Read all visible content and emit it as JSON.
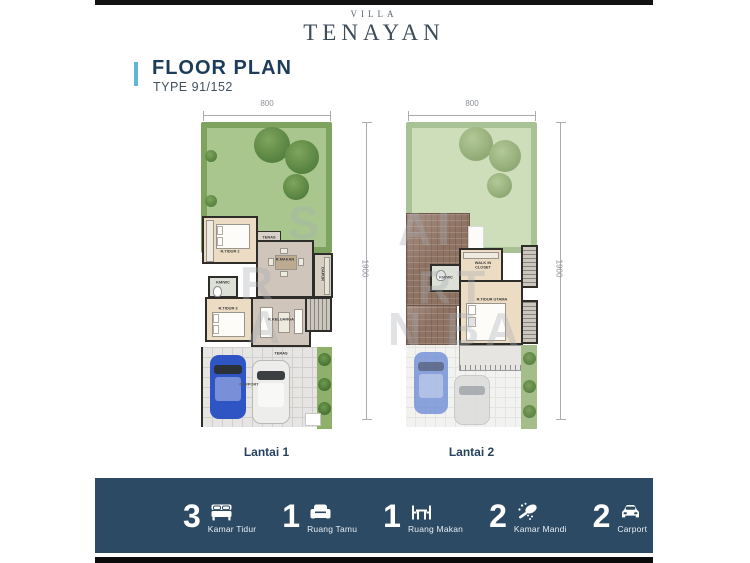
{
  "brand": {
    "eyebrow": "VILLA",
    "name": "TENAYAN"
  },
  "title": {
    "heading": "FLOOR PLAN",
    "type": "TYPE 91/152"
  },
  "plans": [
    {
      "name": "Lantai 1",
      "width_dim": "800",
      "height_dim": "1900",
      "rooms": {
        "bedroom2": "R.TIDUR 2",
        "teras_top": "TERAS",
        "dining": "R.MAKAN",
        "kitchen": "DAPUR",
        "bathroom": "KM/WC",
        "bedroom3": "R.TIDUR 3",
        "living": "R.KELUARGA",
        "teras": "TERAS",
        "carport": "CARPORT"
      }
    },
    {
      "name": "Lantai 2",
      "width_dim": "800",
      "height_dim": "1900",
      "rooms": {
        "bathroom": "KM/WC",
        "walk_in_closet": "WALK IN CLOSET",
        "master_bedroom": "R.TIDUR UTAMA"
      }
    }
  ],
  "features": [
    {
      "count": "3",
      "label": "Kamar Tidur",
      "icon": "bed-icon"
    },
    {
      "count": "1",
      "label": "Ruang Tamu",
      "icon": "sofa-icon"
    },
    {
      "count": "1",
      "label": "Ruang Makan",
      "icon": "dining-table-icon"
    },
    {
      "count": "2",
      "label": "Kamar Mandi",
      "icon": "shower-icon"
    },
    {
      "count": "2",
      "label": "Carport",
      "icon": "car-icon"
    }
  ],
  "watermark": {
    "fragments": [
      "S",
      "AI",
      "R",
      "RT",
      "A",
      "N BA"
    ]
  },
  "colors": {
    "accent_blue": "#5FB7D7",
    "navy_bar": "#2C4A64",
    "heading_navy": "#1D3C5A",
    "lawn_green": "#A9C68E",
    "faded_lawn": "#CFDEBA",
    "roof_brown": "#8E7262",
    "car_blue": "#2F55C4"
  }
}
